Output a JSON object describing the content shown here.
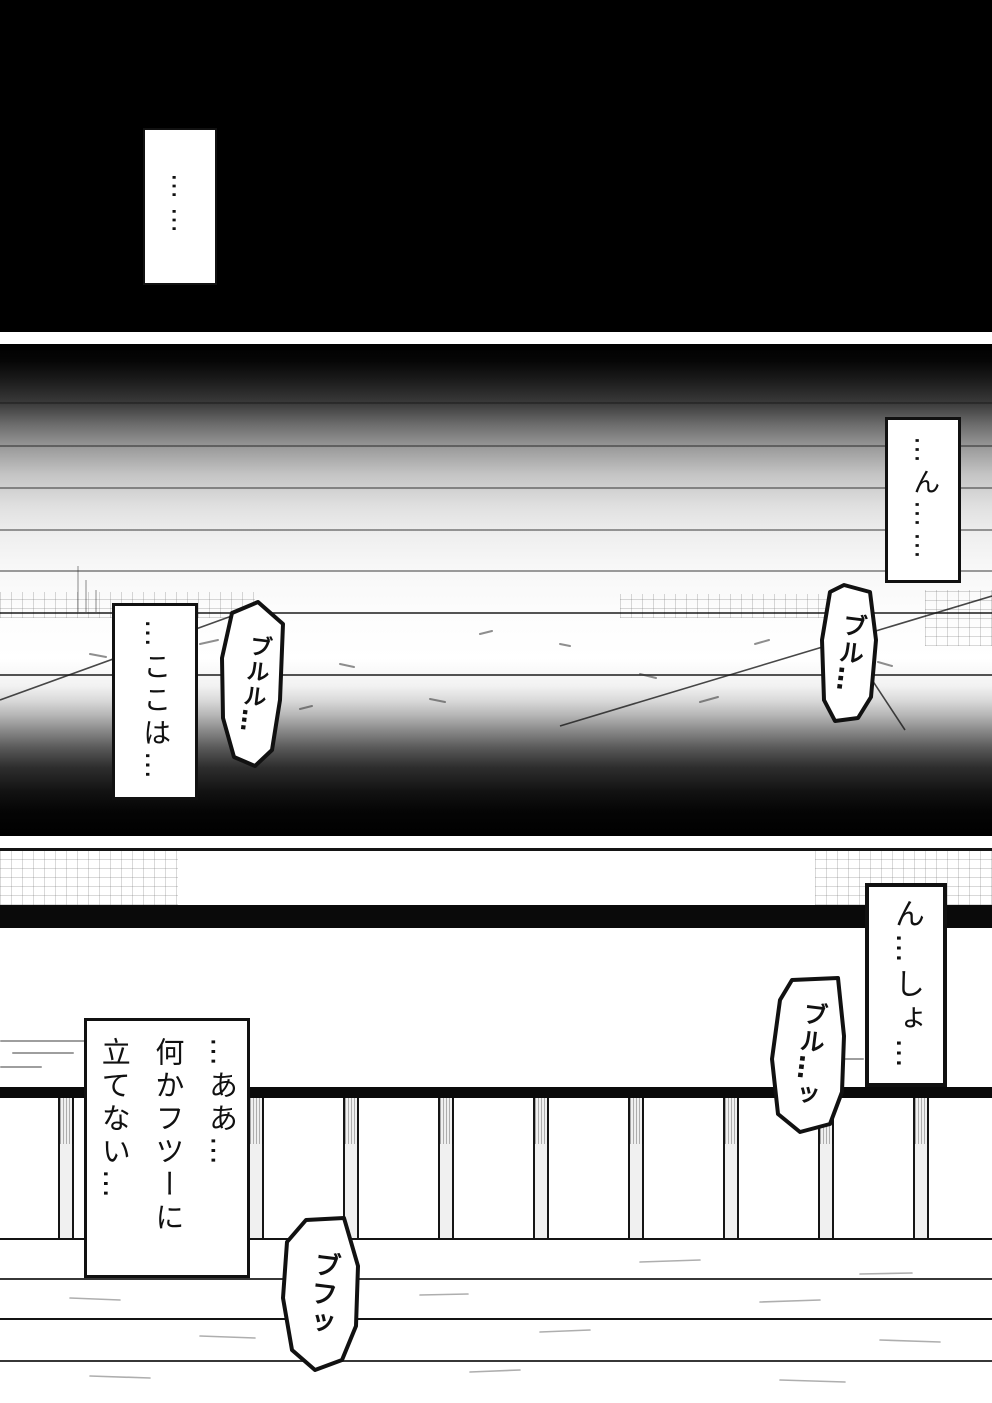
{
  "page_type": "manga-page",
  "colors": {
    "panel_black": "#000000",
    "ink": "#111111",
    "paper": "#ffffff"
  },
  "panels": {
    "top": {
      "caption": "……"
    },
    "middle": {
      "caption_right": "…ん……",
      "sfx_right": "ブル…",
      "caption_left": "…ここは…",
      "sfx_left": "ブルル…"
    },
    "bottom": {
      "caption_right": "ん…しょ…",
      "sfx_right": "ブル…ッ",
      "caption_left_lines": [
        "…ああ…",
        "何かフツーに",
        "立てない…"
      ],
      "sfx_bottom": "ブフッ"
    }
  }
}
